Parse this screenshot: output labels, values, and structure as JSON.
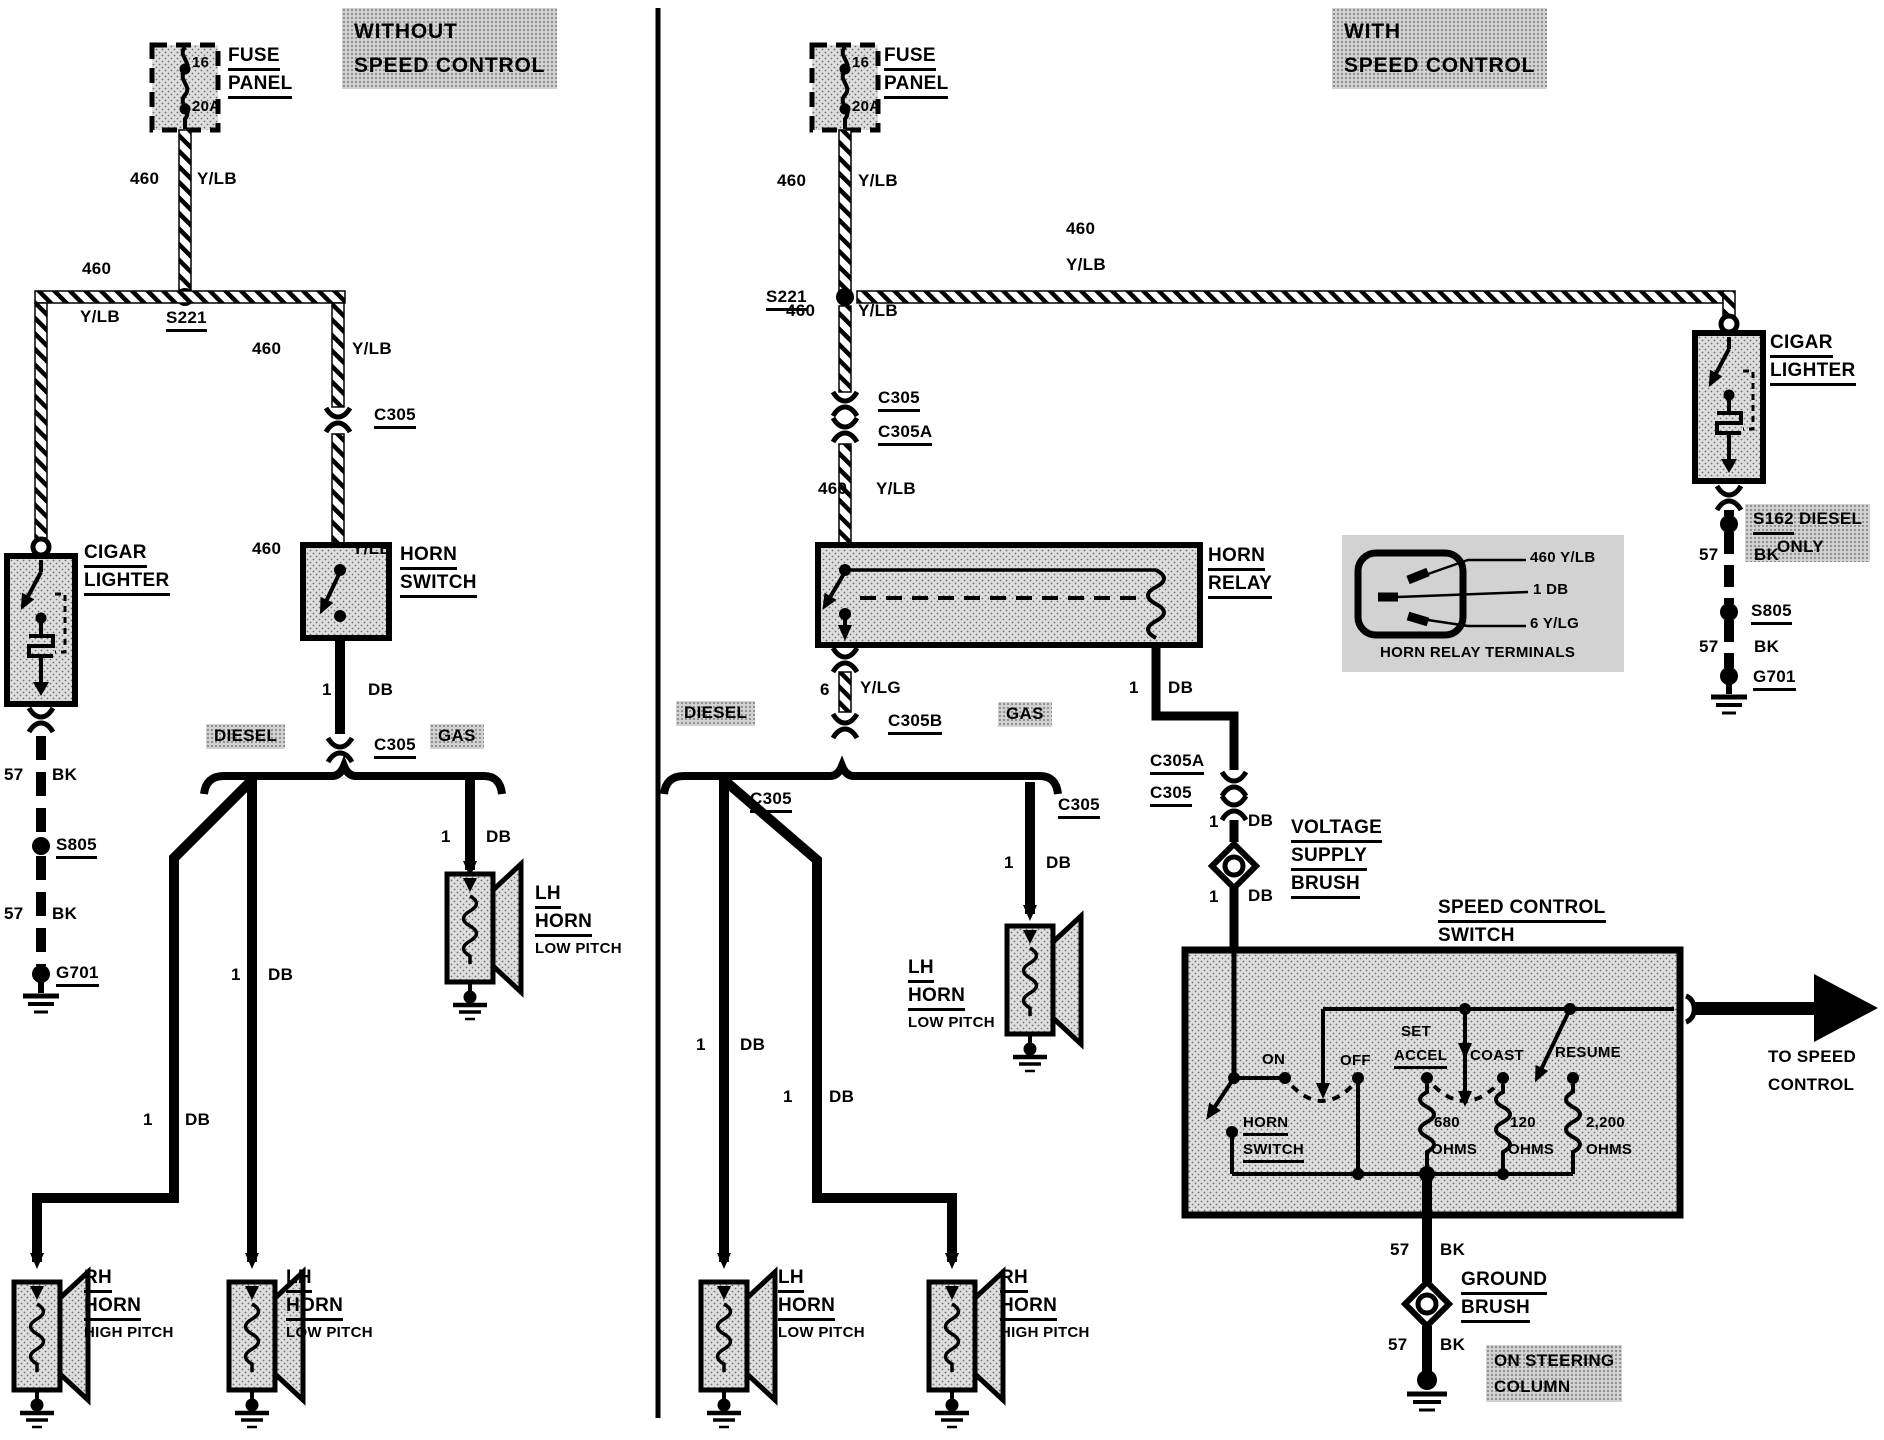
{
  "titles": {
    "left_line1": "WITHOUT",
    "left_line2": "SPEED CONTROL",
    "right_line1": "WITH",
    "right_line2": "SPEED CONTROL"
  },
  "wire": {
    "g460": "460",
    "ylb": "Y/LB",
    "one": "1",
    "db": "DB",
    "n57": "57",
    "bk": "BK",
    "six": "6",
    "ylg": "Y/LG",
    "f16": "16",
    "f20a": "20A",
    "r680": "680",
    "r120": "120",
    "r2200": "2,200",
    "ohms": "OHMS"
  },
  "conn": {
    "s221": "S221",
    "c305": "C305",
    "c305a": "C305A",
    "c305b": "C305B",
    "s805": "S805",
    "g701": "G701",
    "s162": "S162"
  },
  "comp": {
    "fuse": "FUSE",
    "panel": "PANEL",
    "cigar": "CIGAR",
    "lighter": "LIGHTER",
    "horn": "HORN",
    "switch": "SWITCH",
    "relay": "RELAY",
    "voltage": "VOLTAGE",
    "supply": "SUPPLY",
    "brush": "BRUSH",
    "ground": "GROUND",
    "speed_control": "SPEED CONTROL",
    "lh": "LH",
    "rh": "RH",
    "low_pitch": "LOW PITCH",
    "high_pitch": "HIGH PITCH",
    "diesel": "DIESEL",
    "gas": "GAS",
    "only": "ONLY"
  },
  "sw": {
    "on": "ON",
    "off": "OFF",
    "set": "SET",
    "accel": "ACCEL",
    "coast": "COAST",
    "resume": "RESUME"
  },
  "notes": {
    "to_speed": "TO SPEED",
    "control": "CONTROL",
    "on_steering": "ON STEERING",
    "column": "COLUMN",
    "hrt_460": "460 Y/LB",
    "hrt_1db": "1 DB",
    "hrt_6ylg": "6 Y/LG",
    "hrt_caption": "HORN RELAY TERMINALS"
  }
}
